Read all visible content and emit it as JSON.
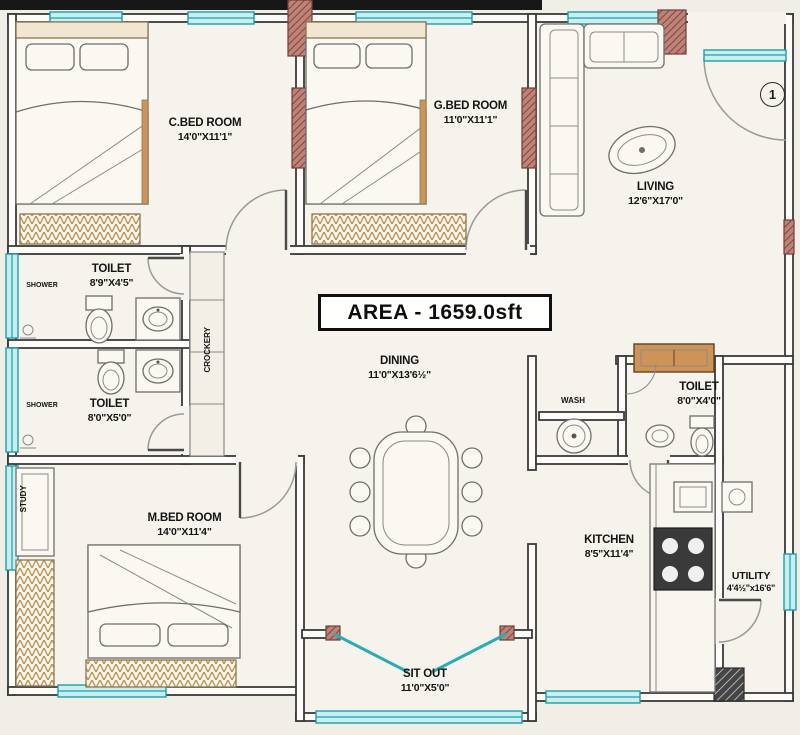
{
  "plan": {
    "title_area": "AREA - 1659.0sft",
    "entrance_marker": "1",
    "rooms": [
      {
        "id": "c-bedroom",
        "name": "C.BED ROOM",
        "dims": "14'0\"X11'1\""
      },
      {
        "id": "g-bedroom",
        "name": "G.BED ROOM",
        "dims": "11'0\"X11'1\""
      },
      {
        "id": "living",
        "name": "LIVING",
        "dims": "12'6\"X17'0\""
      },
      {
        "id": "toilet-top",
        "name": "TOILET",
        "dims": "8'9\"X4'5\""
      },
      {
        "id": "toilet-mid",
        "name": "TOILET",
        "dims": "8'0\"X5'0\""
      },
      {
        "id": "dining",
        "name": "DINING",
        "dims": "11'0\"X13'6½\""
      },
      {
        "id": "m-bedroom",
        "name": "M.BED ROOM",
        "dims": "14'0\"X11'4\""
      },
      {
        "id": "toilet-right",
        "name": "TOILET",
        "dims": "8'0\"X4'0\""
      },
      {
        "id": "kitchen",
        "name": "KITCHEN",
        "dims": "8'5\"X11'4\""
      },
      {
        "id": "utility",
        "name": "UTILITY",
        "dims": "4'4½\"x16'6\""
      },
      {
        "id": "sit-out",
        "name": "SIT OUT",
        "dims": "11'0\"X5'0\""
      }
    ],
    "annotations": {
      "crockery": "CROCKERY",
      "wash": "WASH",
      "study": "STUDY",
      "shower_top": "SHOWER",
      "shower_mid": "SHOWER"
    },
    "colors": {
      "wall": "#3a3a3a",
      "window_frame": "#1f9ea6",
      "window_fill": "#c7eff1",
      "door_post": "#c08277",
      "background": "#f1eee7",
      "accent_wood": "#cd9357"
    }
  }
}
